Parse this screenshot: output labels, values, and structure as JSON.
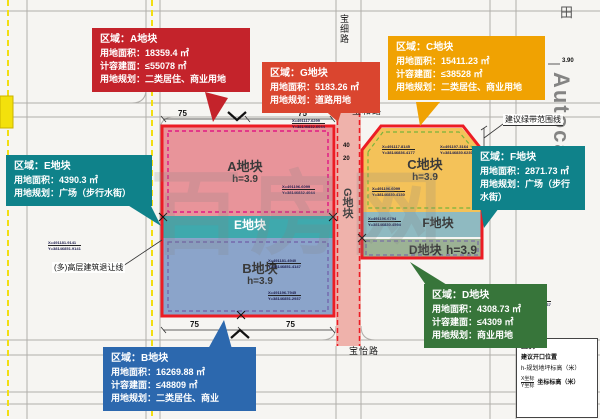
{
  "callouts": {
    "a": {
      "title": "区域：A地块",
      "line1": "用地面积：18359.4 ㎡",
      "line2": "计容建面：≤55078 ㎡",
      "line3": "用地规划：二类居住、商业用地",
      "color": "#c4232b"
    },
    "g": {
      "title": "区域：G地块",
      "line1": "用地面积：5183.26 ㎡",
      "line2": "用地规划：道路用地",
      "color": "#da452f"
    },
    "c": {
      "title": "区域：C地块",
      "line1": "用地面积：15411.23 ㎡",
      "line2": "计容建面：≤38528 ㎡",
      "line3": "用地规划：二类居住、商业用地",
      "color": "#f0a202"
    },
    "e": {
      "title": "区域：E地块",
      "line1": "用地面积：4390.3 ㎡",
      "line2": "用地规划：广场（步行水街）",
      "color": "#0f828a"
    },
    "f": {
      "title": "区域：F地块",
      "line1": "用地面积：2871.73 ㎡",
      "line2": "用地规划：广场（步行水街）",
      "color": "#0f828a"
    },
    "d": {
      "title": "区域：D地块",
      "line1": "用地面积：4308.73 ㎡",
      "line2": "计容建面：≤4309 ㎡",
      "line3": "用地规划：商业用地",
      "color": "#37753a"
    },
    "b": {
      "title": "区域：B地块",
      "line1": "用地面积：16269.88 ㎡",
      "line2": "计容建面：≤48809 ㎡",
      "line3": "用地规划：二类居住、商业",
      "color": "#2c68ae"
    }
  },
  "parcels": {
    "a": {
      "name": "A地块",
      "elev": "h=3.9"
    },
    "b": {
      "name": "B地块",
      "elev": "h=3.9"
    },
    "c": {
      "name": "C地块",
      "elev": "h=3.9"
    },
    "d": {
      "name": "D地块",
      "elev": "h=3.9"
    },
    "e": {
      "name": "E地块"
    },
    "f": {
      "name": "F地块"
    },
    "g": {
      "name": "G地块"
    }
  },
  "roads": {
    "baohe": "宝和路",
    "baoyi": "宝怡路",
    "baoxi": "宝细路"
  },
  "map_labels": {
    "green_belt": "建议绿带范围线",
    "setback": "(多)高层建筑退让线",
    "elev390": "3.90"
  },
  "dims": {
    "seventy_five": "75",
    "forty": "40",
    "twenty": "20"
  },
  "legend": {
    "title": "图例:",
    "opening": "建议开口位置",
    "elevation": "h-规划地坪标高（米）",
    "x_label": "X坐标",
    "y_label": "Y坐标",
    "coord": "坐标标高（米）"
  },
  "watermark": {
    "main": "百房网",
    "vertical": "Autocad",
    "tian": "田"
  },
  "coords": [
    {
      "x": "X=491117.6299",
      "y": "Y=38146832.6044"
    },
    {
      "x": "X=491196.6099",
      "y": "Y=38146832.4044"
    },
    {
      "x": "X=491117.8145",
      "y": "Y=38146836.4177"
    },
    {
      "x": "X=491197.3164",
      "y": "Y=38146830.6230"
    },
    {
      "x": "X=491196.6099",
      "y": "Y=38146830.4130"
    },
    {
      "x": "X=491196.6794",
      "y": "Y=38146830.4594"
    },
    {
      "x": "X=491181.4940",
      "y": "Y=38146851.4147"
    },
    {
      "x": "X=491196.7945",
      "y": "Y=38146851.2937"
    },
    {
      "x": "X=491181.9141",
      "y": "Y=38146851.9141"
    },
    {
      "x": "X=491238.4277",
      "y": "Y=38146851.3567"
    }
  ]
}
